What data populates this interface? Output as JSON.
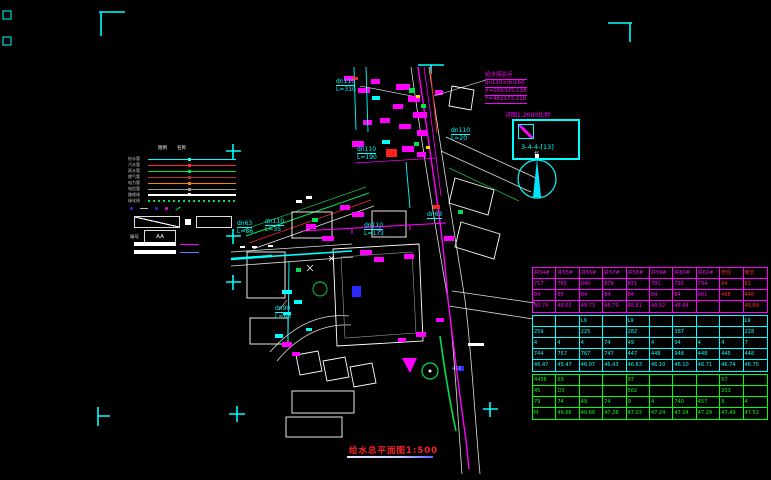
{
  "title": {
    "text": "给水总平面图1:500"
  },
  "north": {
    "label": "北"
  },
  "callout": {
    "lines": [
      "给水接驳点",
      "dn110×dn160",
      "X=266325.138",
      "Y=482173.218"
    ]
  },
  "detail": {
    "label": "详图1:2000比例",
    "ref": "3-4-4-[13]"
  },
  "annotations": [
    {
      "d": "dn110",
      "l": "L=310"
    },
    {
      "d": "dn110",
      "l": "L=190"
    },
    {
      "d": "dn110",
      "l": "L=20"
    },
    {
      "d": "dn63",
      "l": "L=86"
    },
    {
      "d": "dn110",
      "l": "L=35"
    },
    {
      "d": "dn110",
      "l": "L=173"
    },
    {
      "d": "dn63",
      "l": ""
    },
    {
      "d": "dn90",
      "l": "L=66"
    },
    {
      "d": "466",
      "l": ""
    }
  ],
  "legend": {
    "col_headers": [
      "图例",
      "名称"
    ],
    "items": [
      {
        "label": "给水管",
        "color": "#00ffff",
        "style": "solid"
      },
      {
        "label": "污水管",
        "color": "#ff2a2a",
        "style": "solid"
      },
      {
        "label": "雨水管",
        "color": "#00e050",
        "style": "solid"
      },
      {
        "label": "燃气管",
        "color": "#b03030",
        "style": "solid"
      },
      {
        "label": "电力管",
        "color": "#ff7f00",
        "style": "solid"
      },
      {
        "label": "电信管",
        "color": "#9a9a9a",
        "style": "solid"
      },
      {
        "label": "路缘线",
        "color": "#ffffff",
        "style": "solid"
      },
      {
        "label": "绿化线",
        "color": "#00e050",
        "style": "dotted"
      }
    ],
    "extra": {
      "left_label": "编号",
      "box_text": "AA"
    }
  },
  "table": {
    "sections": [
      {
        "id": "existing",
        "color": "#ff00ff",
        "accent": "#ff2a2a",
        "accent_cols": [
          8,
          9
        ],
        "rows": [
          [
            "井54#",
            "井55#",
            "井56#",
            "井57#",
            "井58#",
            "井59#",
            "井60#",
            "井61#",
            "管径",
            "坡长"
          ],
          [
            "717",
            "765",
            "846",
            "879",
            "871",
            "791",
            "792",
            "794",
            "84",
            "81"
          ],
          [
            "84",
            "85",
            "84",
            "84",
            "84",
            "84",
            "84",
            "861",
            "468",
            "446"
          ],
          [
            "48.74",
            "48.63",
            "48.73",
            "48.79",
            "48.81",
            "48.82",
            "48.84",
            "",
            "",
            "48.69"
          ]
        ]
      },
      {
        "id": "design",
        "color": "#00ffff",
        "rows": [
          [
            "",
            "",
            "L9",
            "",
            "L9",
            "",
            "",
            "",
            "",
            "L9"
          ],
          [
            "259",
            "",
            "225",
            "",
            "282",
            "",
            "387",
            "",
            "",
            "228"
          ],
          [
            "4",
            "4",
            "4",
            "74",
            "49",
            "4",
            "94",
            "4",
            "4",
            "7"
          ],
          [
            "744",
            "757",
            "767",
            "747",
            "447",
            "448",
            "948",
            "448",
            "445",
            "448"
          ],
          [
            "46.47",
            "45.47",
            "46.07",
            "46.43",
            "46.63",
            "46.10",
            "46.10",
            "46.71",
            "46.74",
            "46.75"
          ]
        ]
      },
      {
        "id": "road",
        "color": "#00ff00",
        "rows": [
          [
            "4456",
            "69",
            "",
            "",
            "97",
            "",
            "",
            "",
            "57",
            ""
          ],
          [
            "45",
            "D3",
            "",
            "",
            "502",
            "",
            "",
            "",
            "203",
            ""
          ],
          [
            "79",
            "74",
            "49",
            "74",
            "9",
            "4",
            "740",
            "457",
            "9",
            "4"
          ],
          [
            "M",
            "46.66",
            "46.66",
            "47.28",
            "47.03",
            "47.24",
            "47.24",
            "47.29",
            "47.49",
            "47.52"
          ]
        ]
      }
    ]
  },
  "colors": {
    "cyan": "#00ffff",
    "magenta": "#ff00ff",
    "red": "#ff2a2a",
    "green": "#00e050",
    "blue": "#2a2aff",
    "title_red": "#ff2020"
  }
}
